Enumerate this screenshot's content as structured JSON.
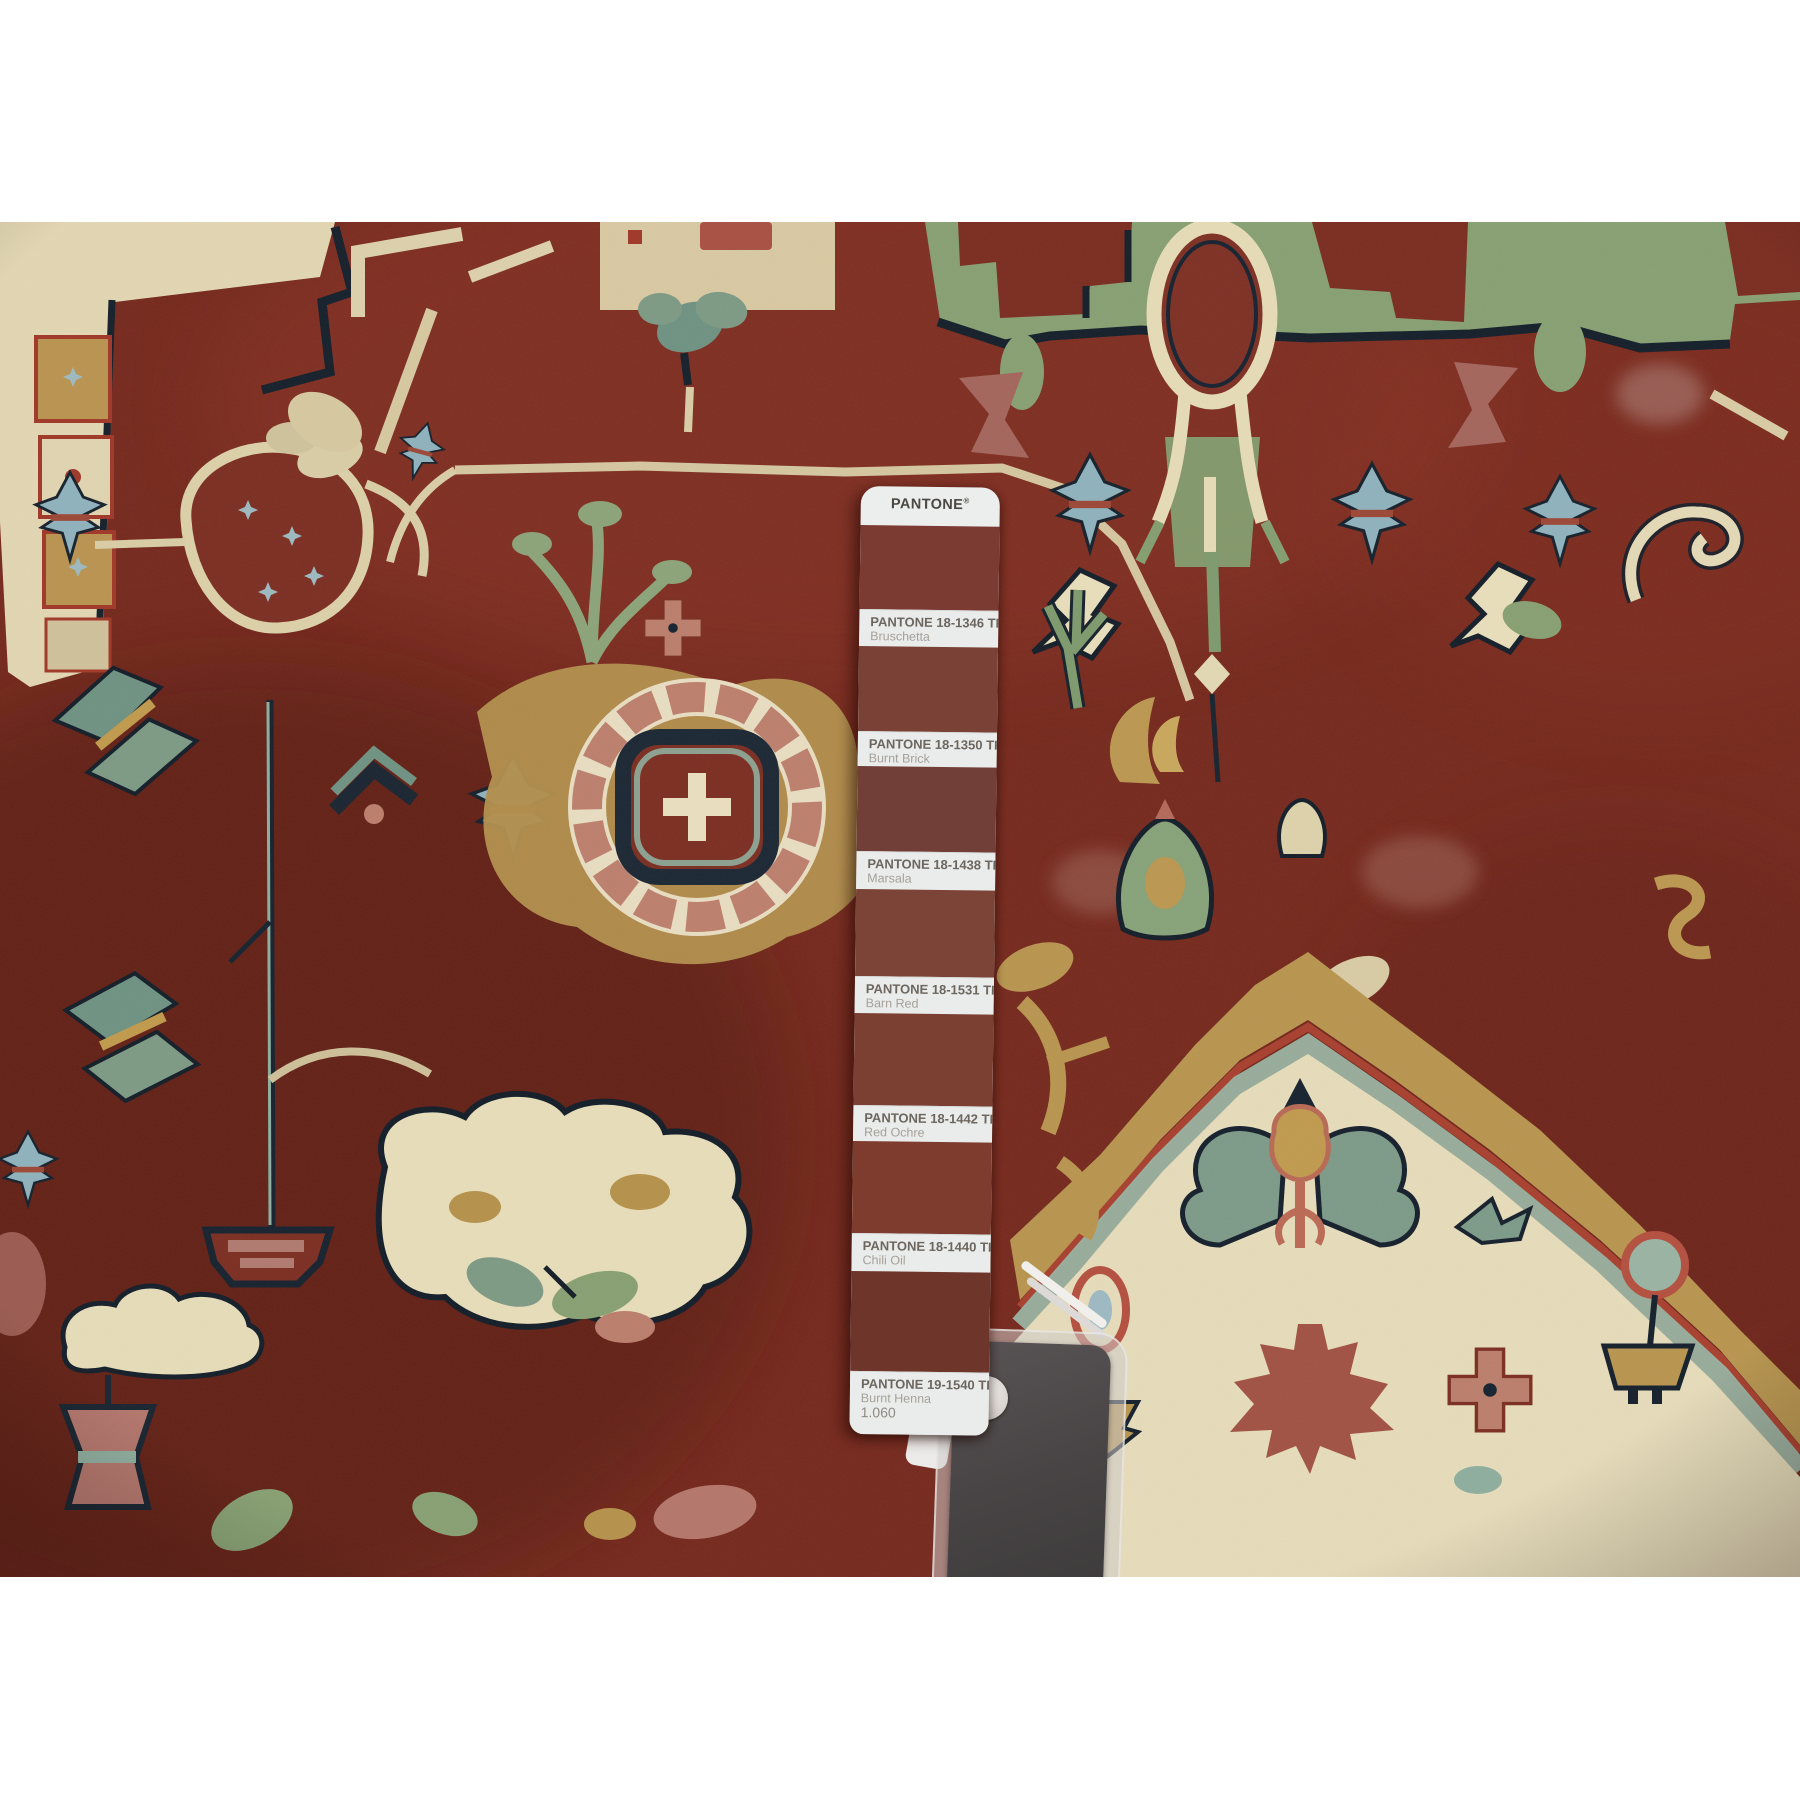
{
  "pantone_strip": {
    "brand": "PANTONE",
    "registered": "®",
    "swatches": [
      {
        "code": "PANTONE 18-1346 TPG",
        "name": "Bruschetta",
        "color": "#7b3a32"
      },
      {
        "code": "PANTONE 18-1350 TPG",
        "name": "Burnt Brick",
        "color": "#7a4136"
      },
      {
        "code": "PANTONE 18-1438 TPG",
        "name": "Marsala",
        "color": "#723f38"
      },
      {
        "code": "PANTONE 18-1531 TPG",
        "name": "Barn Red",
        "color": "#7b4436"
      },
      {
        "code": "PANTONE 18-1442 TPG",
        "name": "Red Ochre",
        "color": "#7c4033"
      },
      {
        "code": "PANTONE 18-1440 TPG",
        "name": "Chili Oil",
        "color": "#7d3c2d"
      },
      {
        "code": "PANTONE 19-1540 TPG",
        "name": "Burnt Henna",
        "color": "#6e352b"
      }
    ],
    "page_number": "1.060"
  },
  "photo": {
    "subject": "hand-knotted red heriz wool rug close-up with Pantone TPG fan deck strip",
    "palette": {
      "field_red": "#76291d",
      "ivory": "#e6dcba",
      "gold": "#b8954f",
      "sage_green": "#87a072",
      "teal": "#7d9a88",
      "light_blue": "#8fb2bd",
      "navy": "#16222e",
      "mauve": "#a4655c",
      "salmon": "#bd7f6d",
      "henna": "#9d4a3c",
      "holder_gray": "#484445"
    }
  }
}
